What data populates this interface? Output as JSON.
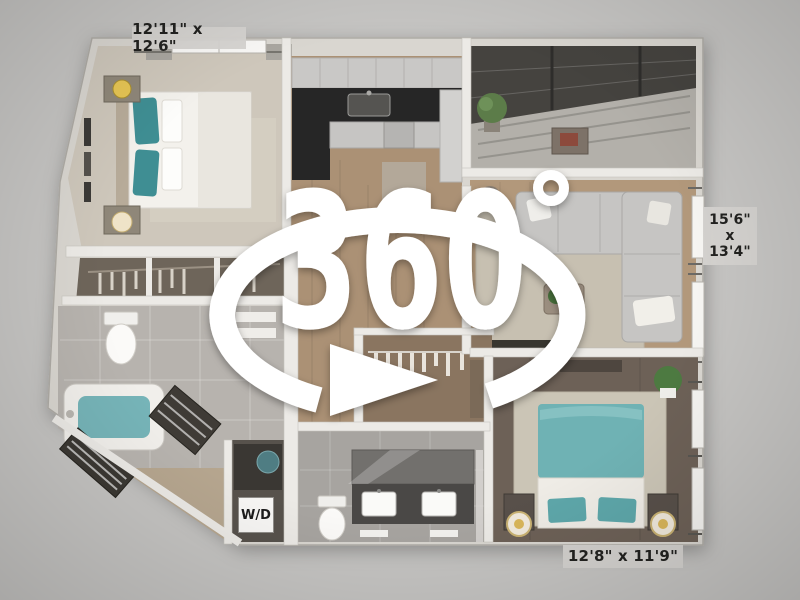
{
  "scene": {
    "type": "3d-floor-plan-render",
    "overlay": {
      "rotation_label": "360",
      "degree_symbol": "°"
    },
    "dimensions": {
      "top_room": "12'11\" x 12'6\"",
      "right_room_lines": [
        "15'6\"",
        "x",
        "13'4\""
      ],
      "bottom_room": "12'8\" x 11'9\""
    },
    "labels": {
      "washer_dryer": "W/D"
    },
    "colors": {
      "background": "#c6c5c3",
      "wall": "#d9d6d0",
      "accent_teal": "#6fb2b4",
      "wood_floor": "#ab9175",
      "dark_wood_floor": "#6d6157",
      "overlay_white": "#ffffff",
      "label_background": "#d5d3d0",
      "label_text": "#222220"
    }
  }
}
